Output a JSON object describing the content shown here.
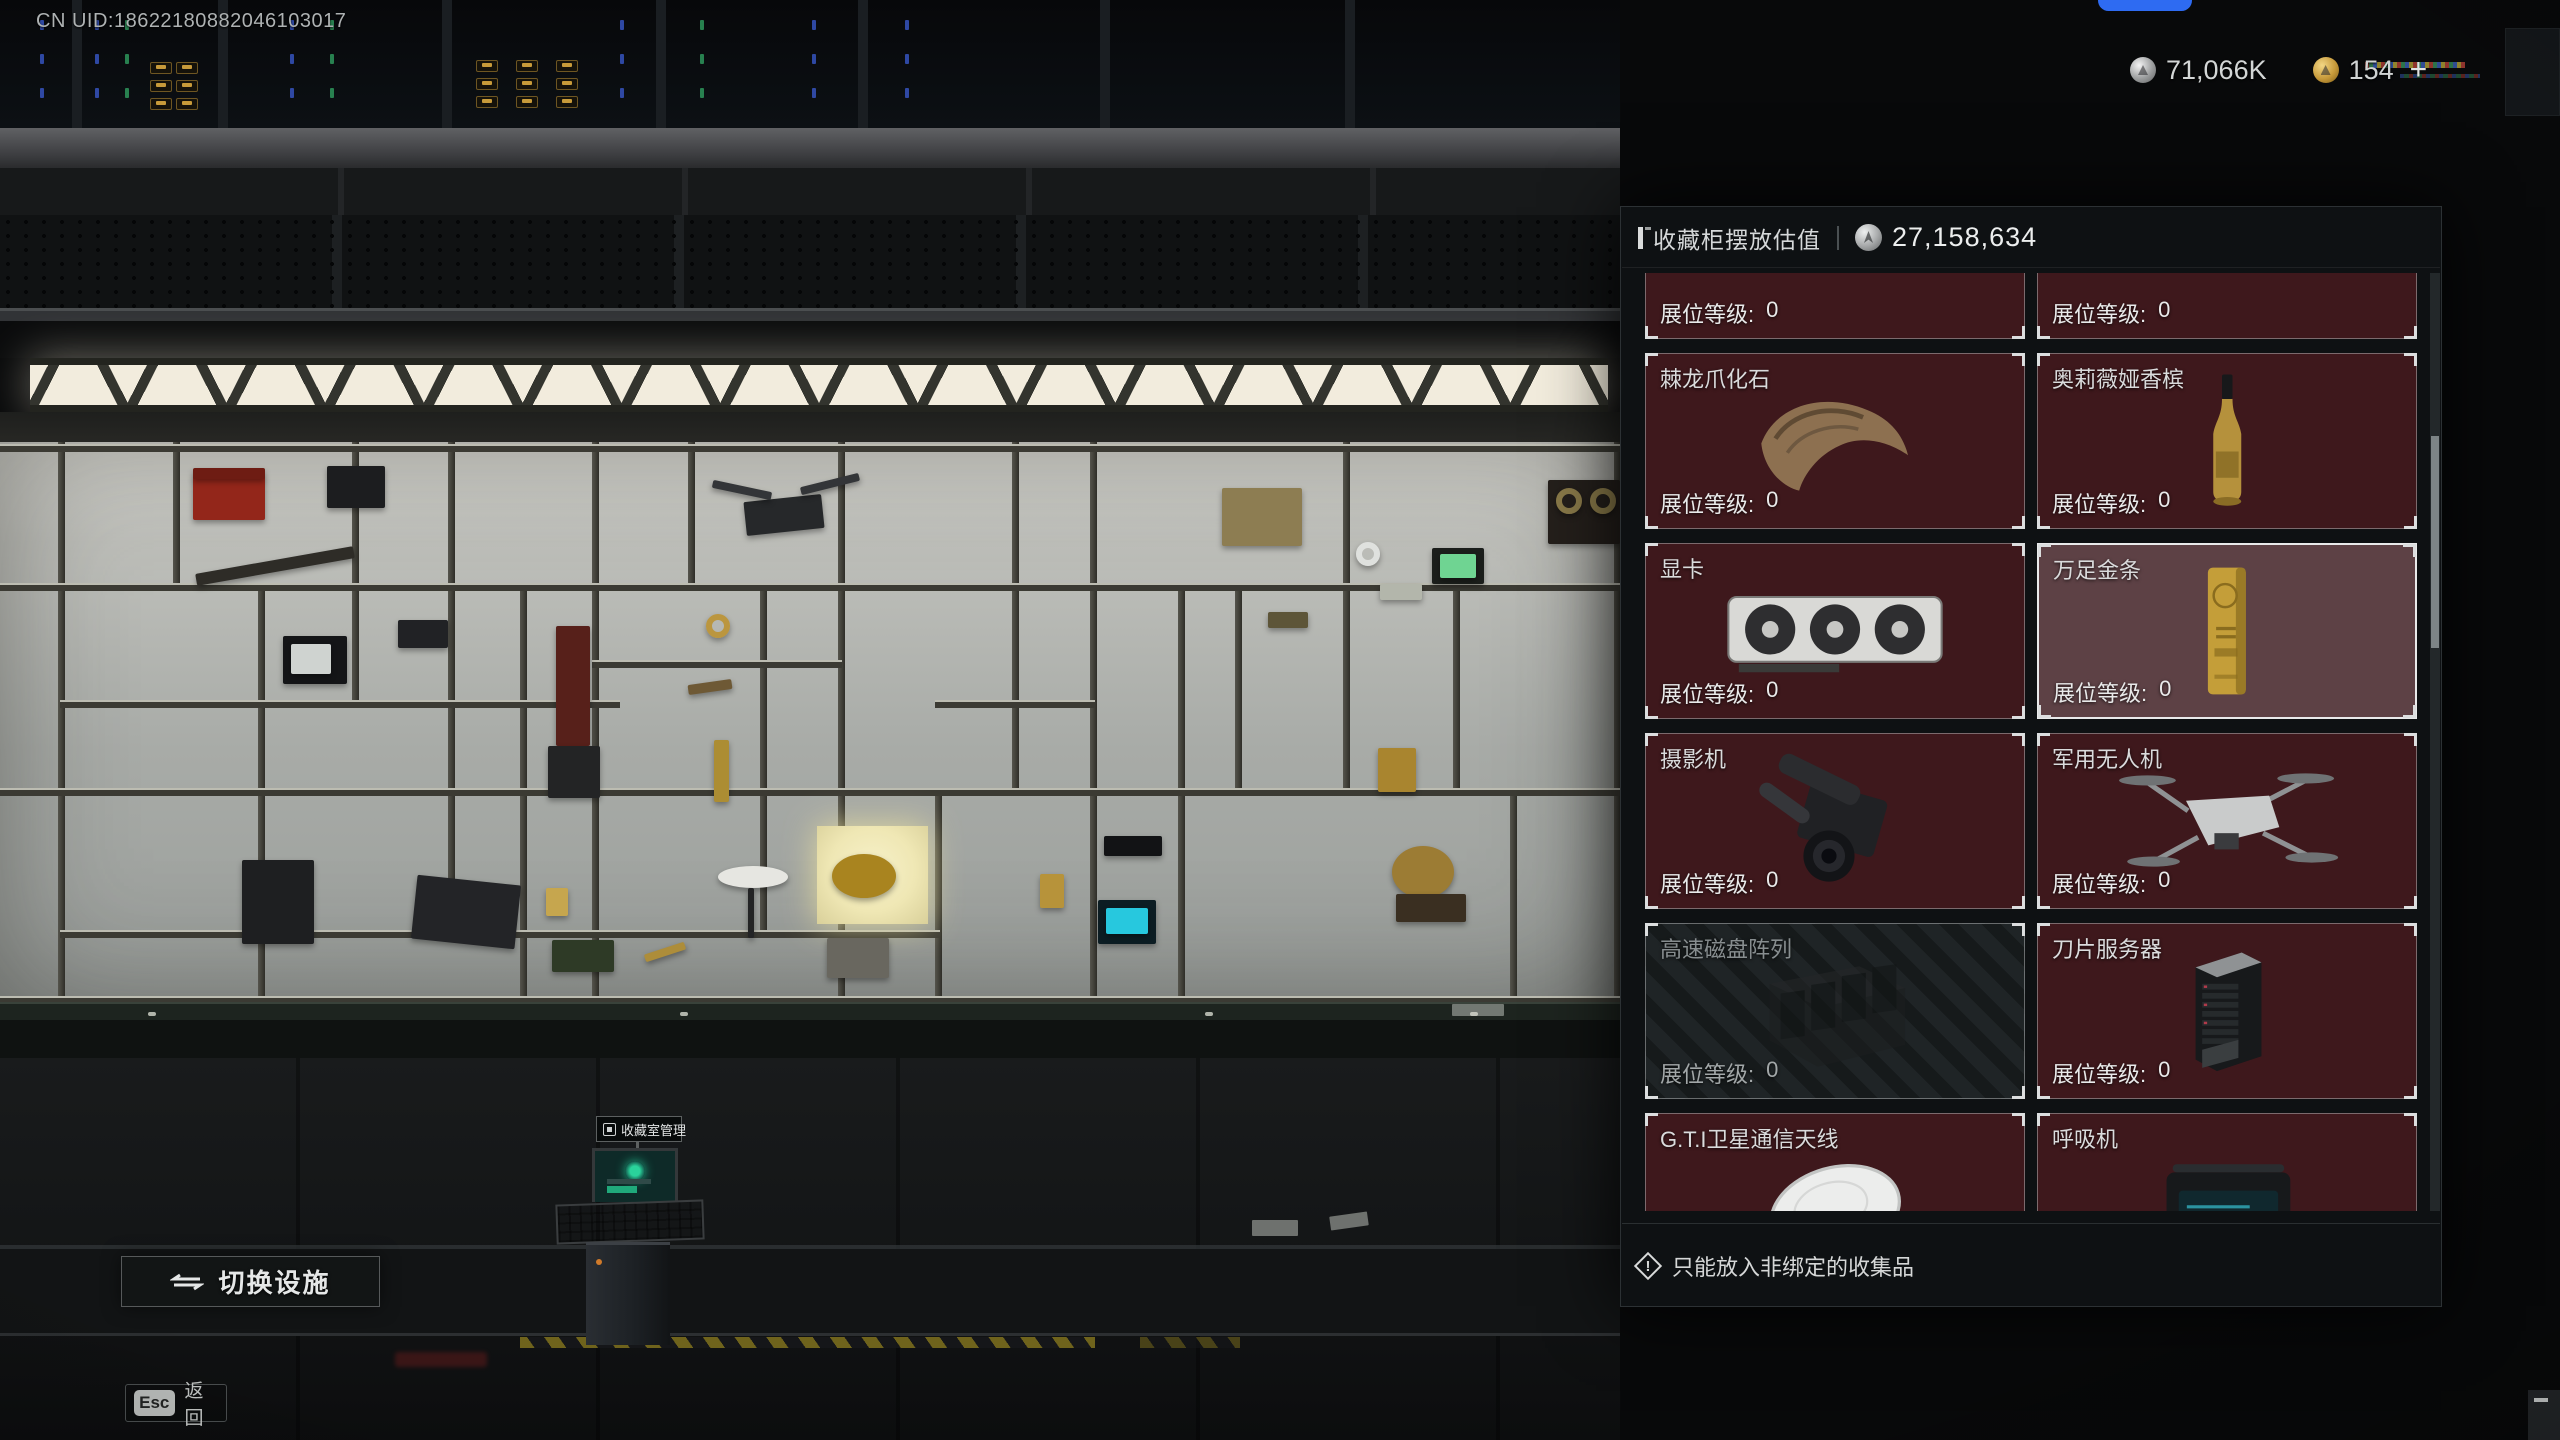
{
  "hud": {
    "uid": "CN UID:18622180882046103017",
    "currencies": [
      {
        "icon": "silver-coin-icon",
        "amount": "71,066K"
      },
      {
        "icon": "gold-coin-icon",
        "amount": "154"
      }
    ],
    "add_plus": "+",
    "switch_facility": "切换设施",
    "esc_key": "Esc",
    "back_label": "返回",
    "terminal_label": "收藏室管理"
  },
  "panel": {
    "title": "收藏柜摆放估值",
    "value_icon": "silver-coin-icon",
    "total_value": "27,158,634",
    "level_label": "展位等级:",
    "footer_note": "只能放入非绑定的收集品",
    "items": [
      {
        "name": "",
        "art": "circuit-board",
        "level": "0",
        "state": "cut-top"
      },
      {
        "name": "",
        "art": "white-part",
        "level": "0",
        "state": "cut-top"
      },
      {
        "name": "棘龙爪化石",
        "art": "claw",
        "level": "0",
        "state": ""
      },
      {
        "name": "奥莉薇娅香槟",
        "art": "champagne",
        "level": "0",
        "state": ""
      },
      {
        "name": "显卡",
        "art": "gpu",
        "level": "0",
        "state": ""
      },
      {
        "name": "万足金条",
        "art": "gold-bar",
        "level": "0",
        "state": "selected"
      },
      {
        "name": "摄影机",
        "art": "camera",
        "level": "0",
        "state": ""
      },
      {
        "name": "军用无人机",
        "art": "drone",
        "level": "0",
        "state": ""
      },
      {
        "name": "高速磁盘阵列",
        "art": "disk-array",
        "level": "0",
        "state": "disabled"
      },
      {
        "name": "刀片服务器",
        "art": "blade-server",
        "level": "0",
        "state": ""
      },
      {
        "name": "G.T.I卫星通信天线",
        "art": "satellite-dish",
        "level": "0",
        "state": "cut-bottom"
      },
      {
        "name": "呼吸机",
        "art": "ventilator",
        "level": "0",
        "state": "cut-bottom"
      }
    ],
    "colors": {
      "card_bg": "#3e181c",
      "card_selected_bg": "#5d4145",
      "card_disabled_bg": "#1f2426",
      "panel_bg": "#0e1214",
      "highlight_glow": "#efe7b4"
    }
  },
  "scene": {
    "shelf_items": [
      {
        "name": "red-toolbox",
        "x": 193,
        "y": 476,
        "w": 72,
        "h": 44,
        "c": "#93261a",
        "shape": "rect"
      },
      {
        "name": "toolbox-lid",
        "x": 193,
        "y": 468,
        "w": 72,
        "h": 11,
        "c": "#6e1c13",
        "shape": "rect"
      },
      {
        "name": "dark-box",
        "x": 327,
        "y": 466,
        "w": 58,
        "h": 42,
        "c": "#1c1d1f",
        "shape": "rect"
      },
      {
        "name": "rifle",
        "x": 195,
        "y": 560,
        "w": 160,
        "h": 12,
        "c": "#2e2c27",
        "r": -10,
        "shape": "rect"
      },
      {
        "name": "spy-camera",
        "x": 398,
        "y": 620,
        "w": 50,
        "h": 28,
        "c": "#212225",
        "shape": "rect"
      },
      {
        "name": "crt-monitor",
        "x": 283,
        "y": 636,
        "w": 64,
        "h": 48,
        "c": "#141517",
        "shape": "rect"
      },
      {
        "name": "crt-screen",
        "x": 291,
        "y": 644,
        "w": 40,
        "h": 30,
        "c": "#cfd3d0",
        "shape": "rect"
      },
      {
        "name": "vacuum-body",
        "x": 556,
        "y": 626,
        "w": 34,
        "h": 120,
        "c": "#57201a",
        "shape": "rect"
      },
      {
        "name": "vacuum-base",
        "x": 548,
        "y": 746,
        "w": 52,
        "h": 52,
        "c": "#232425",
        "shape": "rect"
      },
      {
        "name": "gold-ring",
        "x": 706,
        "y": 614,
        "w": 24,
        "h": 24,
        "c": "#bb963f",
        "shape": "ring"
      },
      {
        "name": "tobacco-pipe",
        "x": 688,
        "y": 682,
        "w": 44,
        "h": 10,
        "c": "#6e5935",
        "r": -8,
        "shape": "rect"
      },
      {
        "name": "wine-bottle",
        "x": 714,
        "y": 740,
        "w": 15,
        "h": 62,
        "c": "#ac8d33",
        "shape": "rect"
      },
      {
        "name": "drone-body",
        "x": 745,
        "y": 498,
        "w": 78,
        "h": 34,
        "c": "#26282a",
        "r": -6,
        "shape": "rect"
      },
      {
        "name": "drone-rotor-left",
        "x": 712,
        "y": 486,
        "w": 60,
        "h": 8,
        "c": "#333538",
        "r": 12,
        "shape": "rect"
      },
      {
        "name": "drone-rotor-right",
        "x": 800,
        "y": 480,
        "w": 60,
        "h": 8,
        "c": "#333538",
        "r": -14,
        "shape": "rect"
      },
      {
        "name": "white-plate",
        "x": 718,
        "y": 866,
        "w": 70,
        "h": 22,
        "c": "#e6e6e1",
        "shape": "ellipse"
      },
      {
        "name": "plate-stand",
        "x": 748,
        "y": 888,
        "w": 6,
        "h": 50,
        "c": "#232425",
        "shape": "rect"
      },
      {
        "name": "gold-artifact-bowl",
        "x": 832,
        "y": 854,
        "w": 64,
        "h": 44,
        "c": "#a9841f",
        "shape": "ellipse"
      },
      {
        "name": "stone-tablet",
        "x": 827,
        "y": 938,
        "w": 62,
        "h": 40,
        "c": "#69675f",
        "shape": "rect"
      },
      {
        "name": "gold-idol",
        "x": 1040,
        "y": 874,
        "w": 24,
        "h": 34,
        "c": "#b7933a",
        "shape": "rect"
      },
      {
        "name": "goggles",
        "x": 1104,
        "y": 836,
        "w": 58,
        "h": 20,
        "c": "#121315",
        "shape": "rect"
      },
      {
        "name": "holo-device",
        "x": 1098,
        "y": 900,
        "w": 58,
        "h": 44,
        "c": "#0c1d23",
        "shape": "rect"
      },
      {
        "name": "holo-screen",
        "x": 1106,
        "y": 908,
        "w": 42,
        "h": 26,
        "c": "#27c8de",
        "shape": "rect"
      },
      {
        "name": "military-radio",
        "x": 1222,
        "y": 488,
        "w": 80,
        "h": 58,
        "c": "#8d7d52",
        "shape": "rect"
      },
      {
        "name": "tank-model",
        "x": 1268,
        "y": 612,
        "w": 40,
        "h": 16,
        "c": "#5d5538",
        "shape": "rect"
      },
      {
        "name": "cd-disc",
        "x": 1356,
        "y": 542,
        "w": 24,
        "h": 24,
        "c": "#dfe1de",
        "shape": "ring"
      },
      {
        "name": "field-monitor",
        "x": 1432,
        "y": 548,
        "w": 52,
        "h": 36,
        "c": "#1b1e1b",
        "shape": "rect"
      },
      {
        "name": "field-monitor-screen",
        "x": 1440,
        "y": 554,
        "w": 36,
        "h": 24,
        "c": "#6fd492",
        "shape": "rect"
      },
      {
        "name": "reel-recorder",
        "x": 1548,
        "y": 480,
        "w": 72,
        "h": 64,
        "c": "#241f1b",
        "shape": "rect"
      },
      {
        "name": "reel-left",
        "x": 1556,
        "y": 488,
        "w": 26,
        "h": 26,
        "c": "#8a7a49",
        "shape": "ring"
      },
      {
        "name": "reel-right",
        "x": 1590,
        "y": 488,
        "w": 26,
        "h": 26,
        "c": "#8a7a49",
        "shape": "ring"
      },
      {
        "name": "money-stack",
        "x": 1380,
        "y": 584,
        "w": 42,
        "h": 16,
        "c": "#b3b6ab",
        "shape": "rect"
      },
      {
        "name": "gold-deer-statue",
        "x": 1378,
        "y": 748,
        "w": 38,
        "h": 44,
        "c": "#a9852f",
        "shape": "rect"
      },
      {
        "name": "gramophone-horn",
        "x": 1392,
        "y": 846,
        "w": 62,
        "h": 52,
        "c": "#9c7c34",
        "shape": "ellipse"
      },
      {
        "name": "gramophone-base",
        "x": 1396,
        "y": 894,
        "w": 70,
        "h": 28,
        "c": "#3a2f21",
        "shape": "rect"
      },
      {
        "name": "vintage-radio",
        "x": 242,
        "y": 860,
        "w": 72,
        "h": 84,
        "c": "#1e1f21",
        "shape": "rect"
      },
      {
        "name": "briefcase",
        "x": 414,
        "y": 880,
        "w": 104,
        "h": 64,
        "c": "#232427",
        "r": 6,
        "shape": "rect"
      },
      {
        "name": "ammo-box",
        "x": 552,
        "y": 940,
        "w": 62,
        "h": 32,
        "c": "#2e3a26",
        "shape": "rect"
      },
      {
        "name": "gold-pen",
        "x": 644,
        "y": 948,
        "w": 42,
        "h": 8,
        "c": "#ad8d3a",
        "r": -18,
        "shape": "rect"
      },
      {
        "name": "gold-card",
        "x": 546,
        "y": 888,
        "w": 22,
        "h": 28,
        "c": "#c6a64e",
        "shape": "rect"
      },
      {
        "name": "heart-decal",
        "x": 1046,
        "y": 1044,
        "w": 24,
        "h": 22,
        "c": "#8a4152",
        "shape": "ellipse"
      }
    ]
  }
}
